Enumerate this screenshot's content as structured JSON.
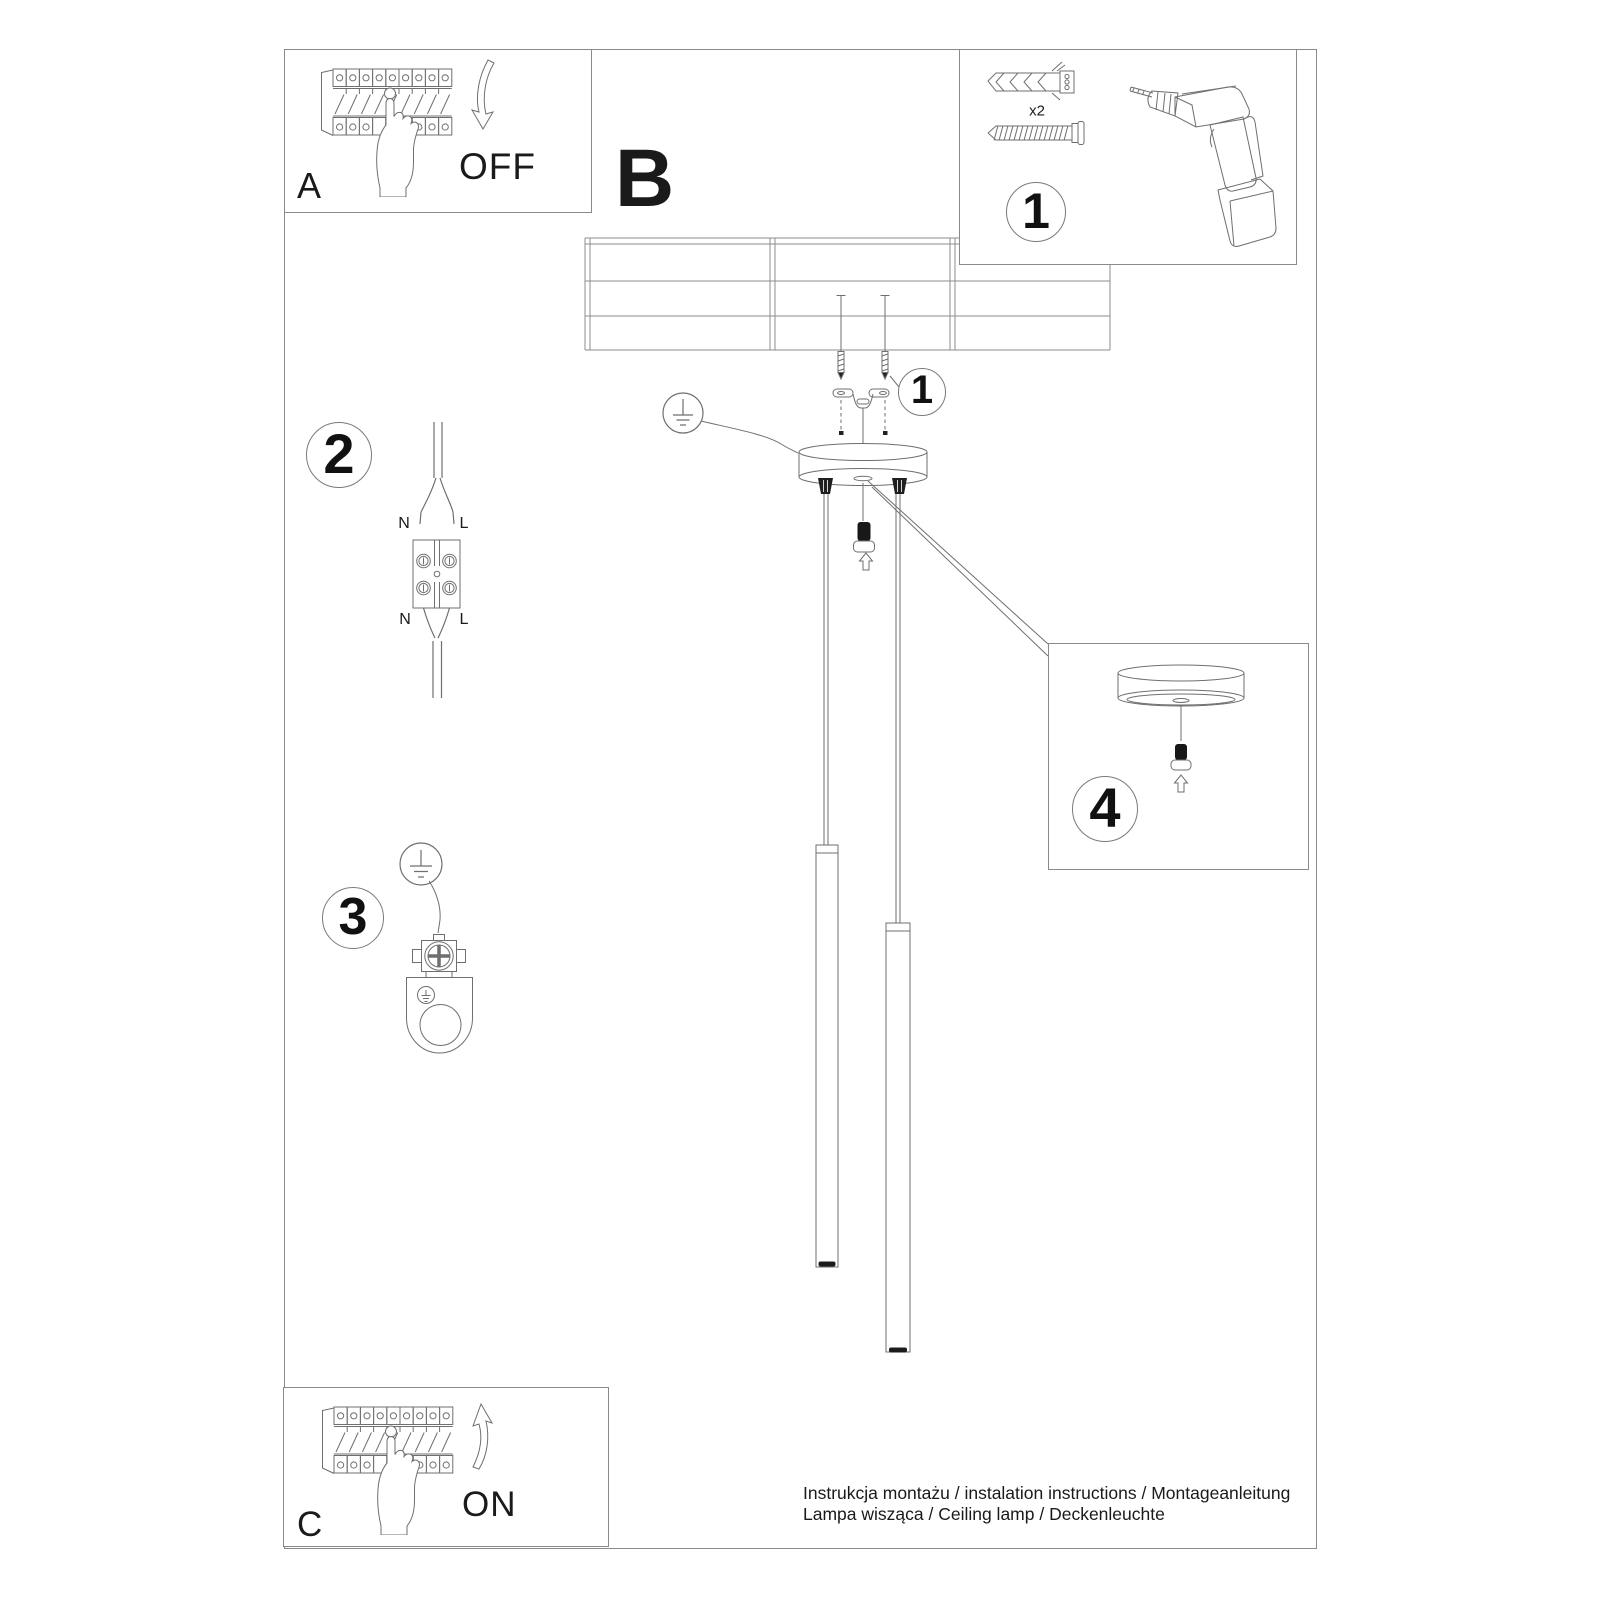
{
  "panels": {
    "a": {
      "label": "A",
      "action": "OFF"
    },
    "b": {
      "label": "B"
    },
    "c": {
      "label": "C",
      "action": "ON"
    },
    "tools": {
      "number": "1",
      "quantity": "x2"
    },
    "canopy_detail": {
      "number": "4"
    }
  },
  "callouts": {
    "mount": "1",
    "wiring": "2",
    "ground": "3"
  },
  "wiring_labels": {
    "top_neutral": "N",
    "top_live": "L",
    "bottom_neutral": "N",
    "bottom_live": "L"
  },
  "footer": {
    "line1": "Instrukcja montażu / instalation instructions / Montageanleitung",
    "line2": "Lampa wisząca / Ceiling lamp / Deckenleuchte"
  }
}
